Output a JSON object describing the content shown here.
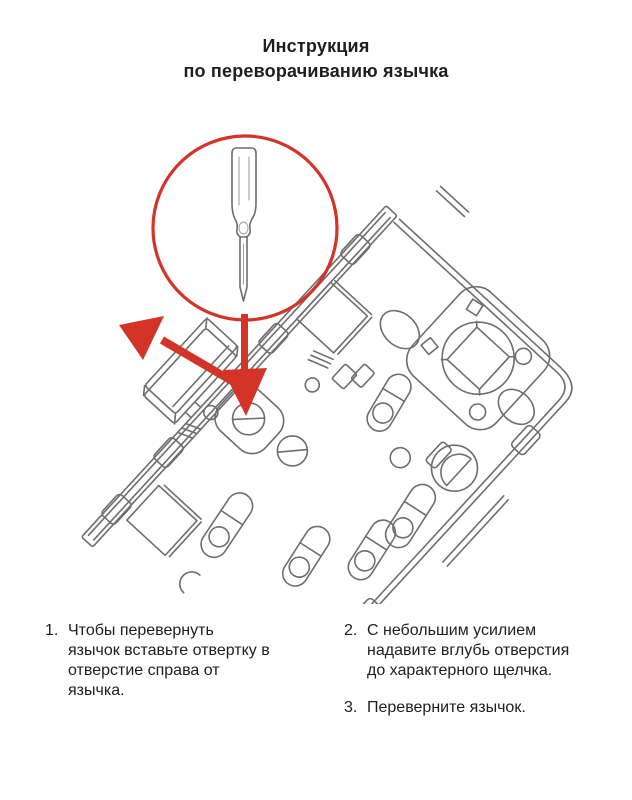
{
  "title": {
    "line1": "Инструкция",
    "line2": "по переворачиванию язычка"
  },
  "figure": {
    "icons": [
      "lock-mechanism-drawing",
      "callout-circle-icon",
      "screwdriver-icon",
      "arrow-down-icon",
      "arrow-up-left-icon"
    ]
  },
  "colors": {
    "accent_red": "#d43428",
    "line_gray": "#6e6e6e",
    "text_dark": "#1e1e1e",
    "background": "#ffffff"
  },
  "instructions": {
    "items": [
      {
        "number": "1.",
        "text": "Чтобы перевернуть\nязычок вставьте отвертку в\nотверстие справа от\nязычка."
      },
      {
        "number": "2.",
        "text": "С небольшим усилием\nнадавите вглубь отверстия\nдо характерного щелчка."
      },
      {
        "number": "3.",
        "text": "Переверните язычок."
      }
    ]
  }
}
